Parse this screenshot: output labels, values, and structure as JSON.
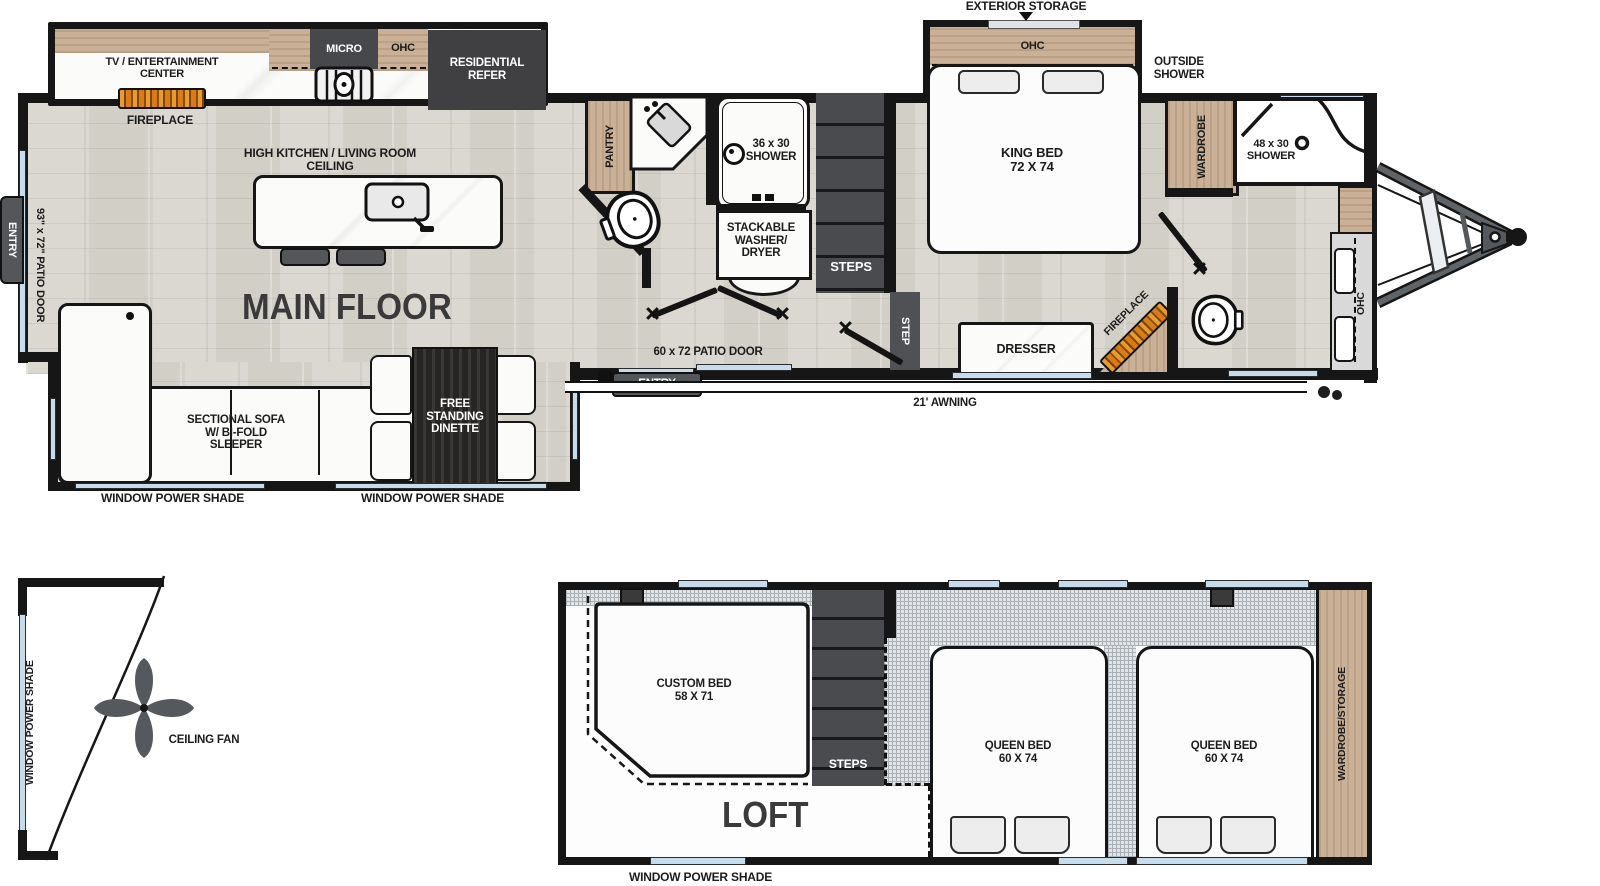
{
  "main_floor": {
    "title": "MAIN FLOOR",
    "rear_galley": {
      "tv": "TV / ENTERTAINMENT\nCENTER",
      "fireplace": "FIREPLACE",
      "micro": "MICRO",
      "ohc": "OHC",
      "refer": "RESIDENTIAL\nREFER",
      "ceiling": "HIGH KITCHEN / LIVING ROOM CEILING"
    },
    "living": {
      "sofa": "SECTIONAL SOFA\nW/ BI-FOLD\nSLEEPER",
      "dinette": "FREE\nSTANDING\nDINETTE",
      "shade_sofa": "WINDOW POWER SHADE",
      "shade_dinette": "WINDOW POWER SHADE",
      "patio_door": "93\" x 72\" PATIO DOOR",
      "entry": "ENTRY"
    },
    "bath": {
      "pantry": "PANTRY",
      "shower": "36 x 30\nSHOWER",
      "washer": "STACKABLE\nWASHER/\nDRYER",
      "steps": "STEPS",
      "step": "STEP"
    },
    "center_entry": {
      "patio_door": "60 x 72 PATIO DOOR",
      "entry": "ENTRY",
      "awning": "21' AWNING"
    },
    "bedroom": {
      "exterior_storage": "EXTERIOR STORAGE",
      "ohc": "OHC",
      "king_bed": "KING BED\n72 X 74",
      "outside_shower": "OUTSIDE\nSHOWER",
      "wardrobe": "WARDROBE",
      "dresser": "DRESSER",
      "fireplace": "FIREPLACE"
    },
    "front_bath": {
      "shower": "48 x 30\nSHOWER",
      "ohc": "OHC"
    }
  },
  "loft": {
    "title": "LOFT",
    "custom_bed": "CUSTOM BED\n58 X 71",
    "steps": "STEPS",
    "queen_bed_left": "QUEEN BED\n60 X 74",
    "queen_bed_right": "QUEEN BED\n60 X 74",
    "wardrobe": "WARDROBE/STORAGE",
    "shade": "WINDOW POWER SHADE"
  },
  "fan_detail": {
    "shade": "WINDOW POWER SHADE",
    "label": "CEILING FAN"
  }
}
